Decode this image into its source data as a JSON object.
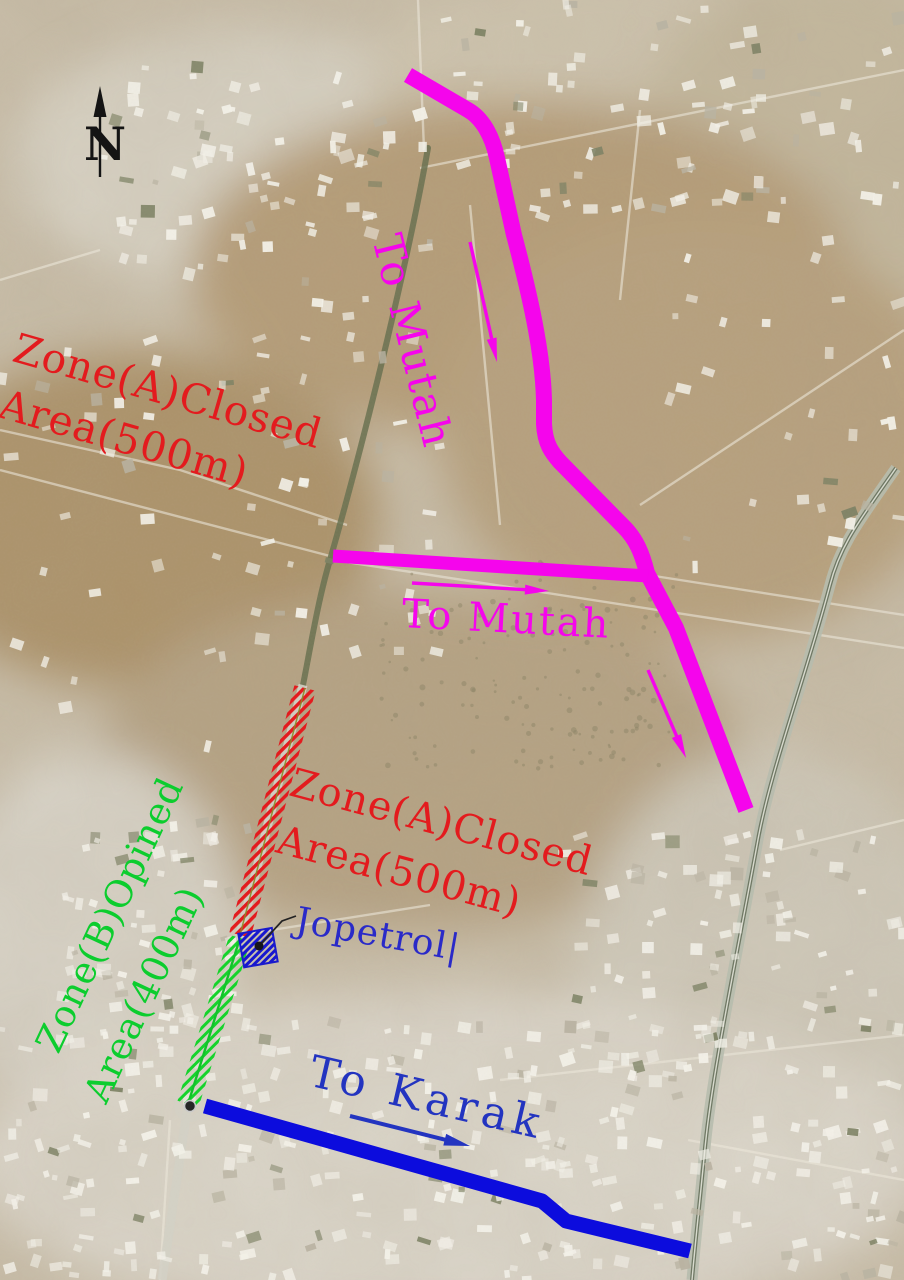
{
  "map": {
    "north_indicator": {
      "label": "N"
    },
    "zones": {
      "zone_a_upper": {
        "line1": "Zone(A)Closed",
        "line2": "Area(500m)",
        "color": "#e31b1e"
      },
      "zone_a_road": {
        "line1": "Zone(A)Closed",
        "line2": "Area(500m)",
        "color": "#e31b1e"
      },
      "zone_b": {
        "line1": "Zone(B)Opined",
        "line2": "Area(400m)",
        "color": "#0ccd2e"
      }
    },
    "routes": {
      "to_mutah_upper": {
        "label": "To Mutah",
        "color": "#f505ec"
      },
      "to_mutah_mid": {
        "label": "To Mutah",
        "color": "#f505ec"
      },
      "to_karak": {
        "label": "To Karak",
        "color": "#2334c0"
      }
    },
    "poi": {
      "jopetrol": {
        "label": "Jopetrol|",
        "color": "#2a2ac8"
      }
    },
    "legend_colors": {
      "closed_zone_hatch": "#e31b1e",
      "open_zone_hatch": "#16d32c",
      "detour_road": "#f505ec",
      "karak_road": "#0c0cdd",
      "north_arrow": "#141414"
    }
  }
}
